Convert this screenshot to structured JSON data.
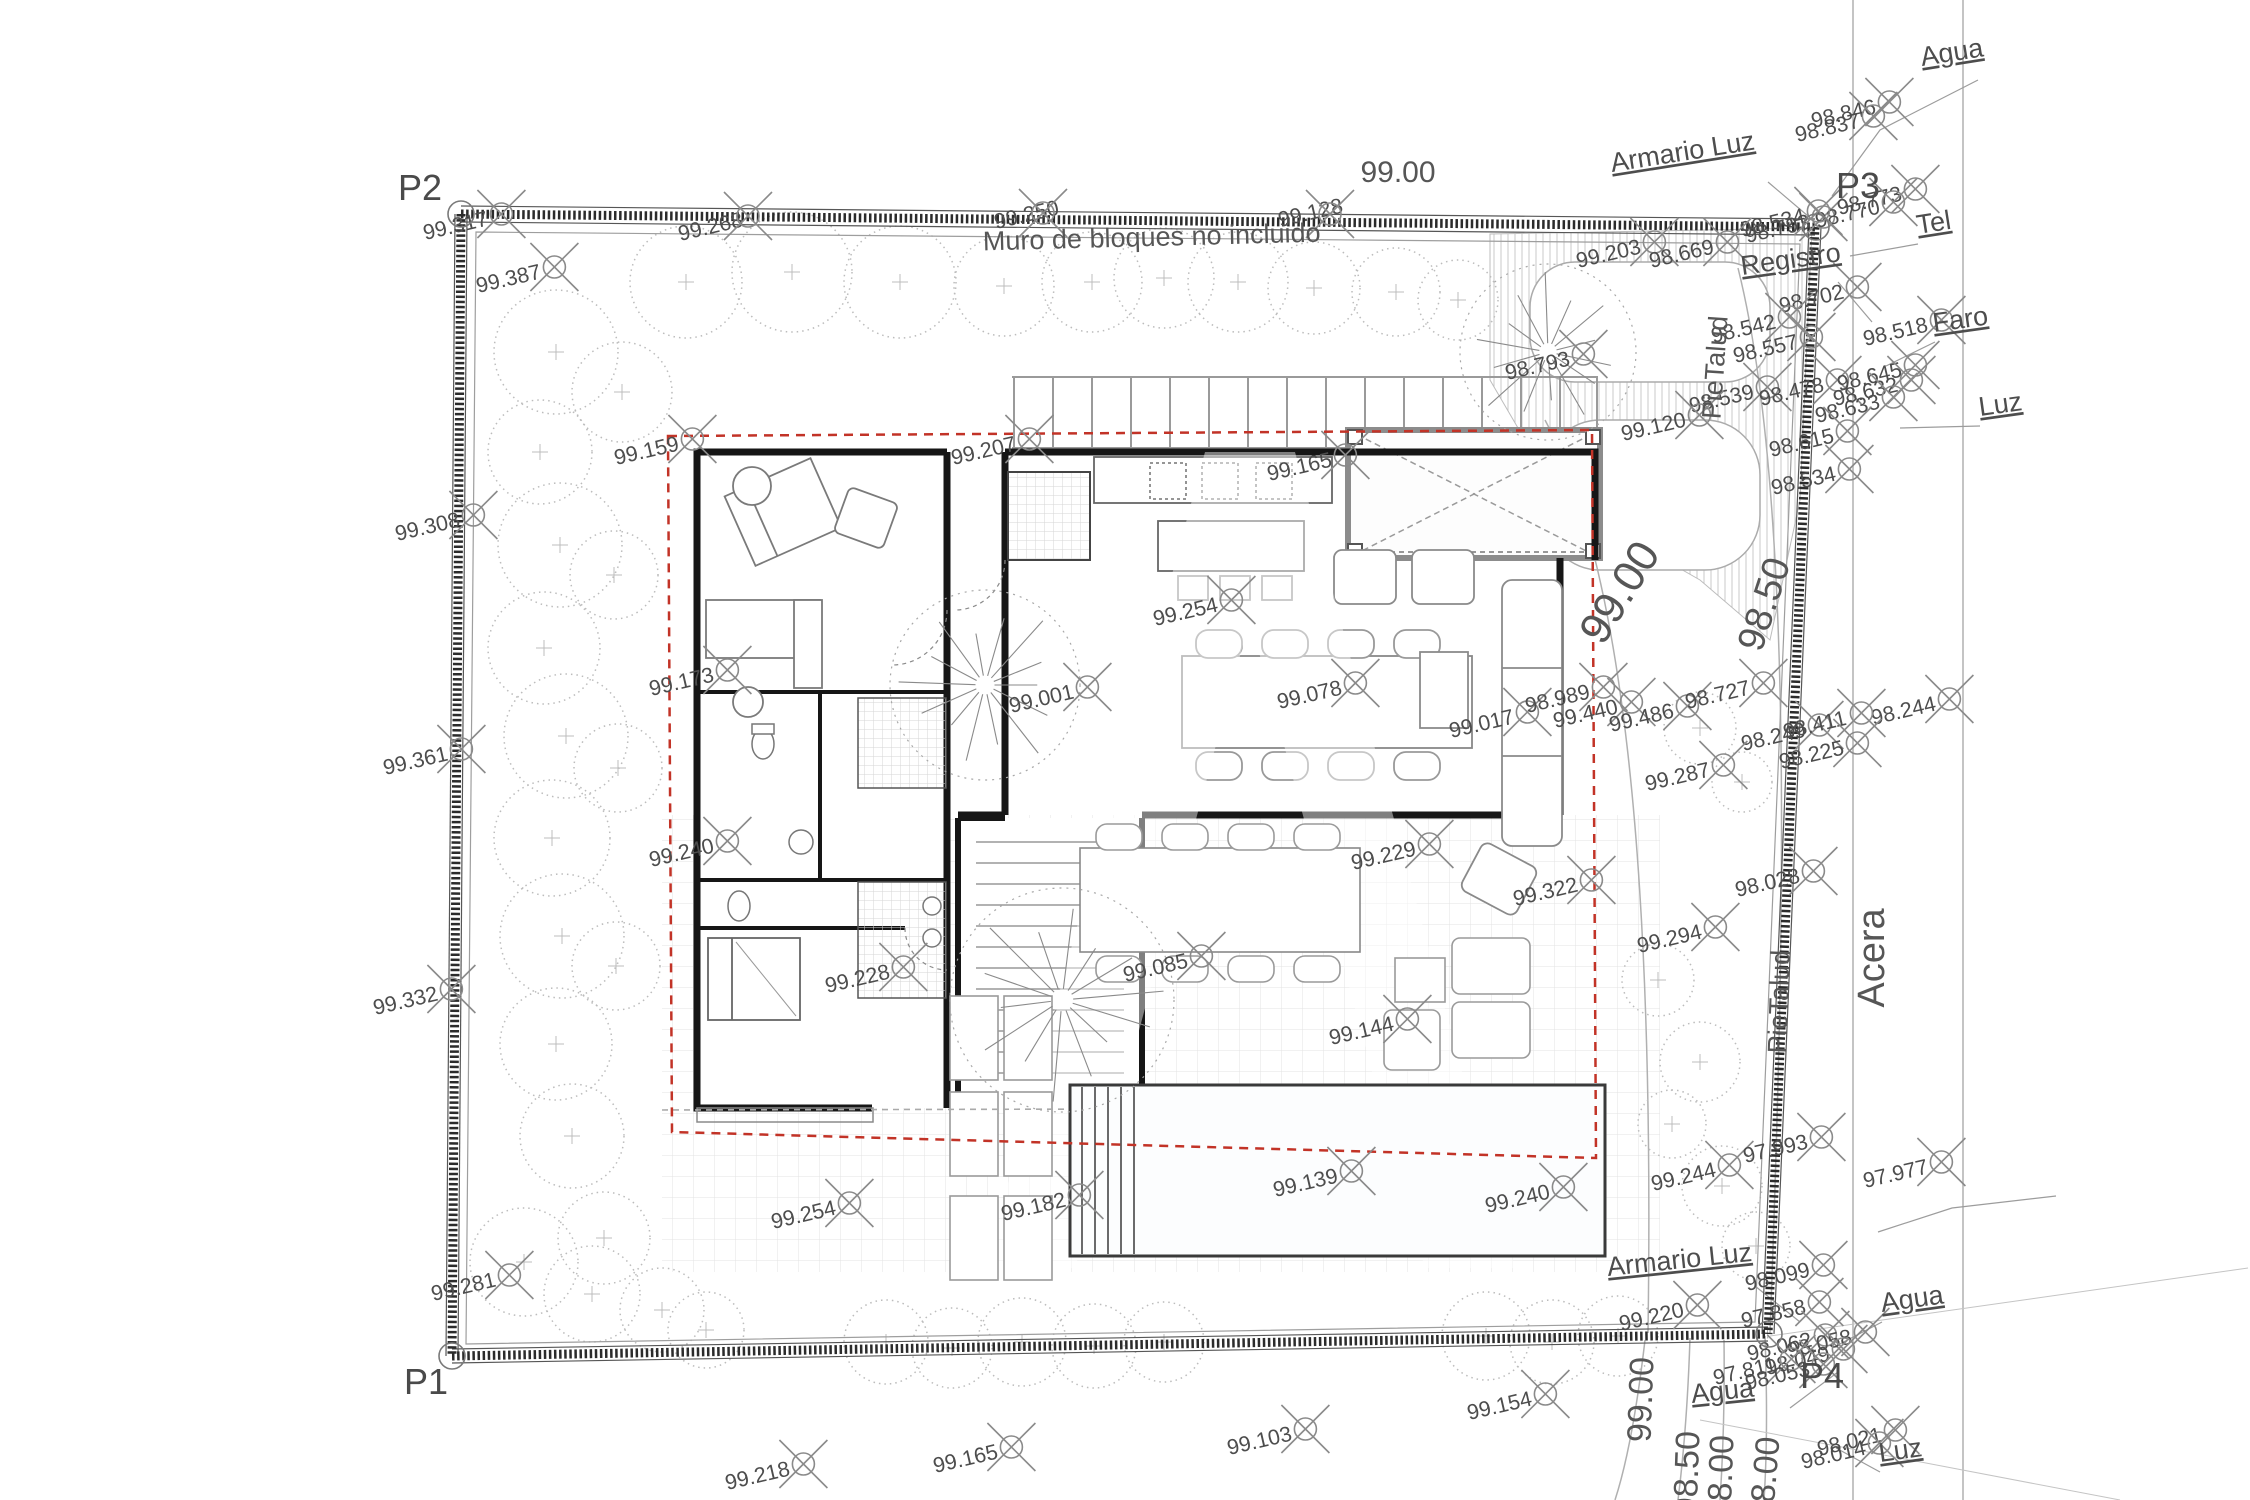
{
  "plan": {
    "wall_note": "Muro de bloques no incluido",
    "street_label": "Acera",
    "corner_points": [
      {
        "t": "P1",
        "x": 404,
        "y": 1394,
        "cx": 452,
        "cy": 1356
      },
      {
        "t": "P2",
        "x": 398,
        "y": 200,
        "cx": 461,
        "cy": 214
      },
      {
        "t": "P3",
        "x": 1836,
        "y": 198,
        "cx": 1816,
        "cy": 227
      },
      {
        "t": "P4",
        "x": 1800,
        "y": 1388,
        "cx": 1769,
        "cy": 1334
      }
    ],
    "big_labels": [
      [
        "99.00",
        1398,
        182,
        0,
        30
      ],
      [
        "Muro de bloques no incluido",
        1152,
        246,
        -1.5,
        27
      ],
      [
        "99.00",
        1632,
        600,
        -58,
        44
      ],
      [
        "98.50",
        1776,
        608,
        -72,
        38
      ],
      [
        "Acera",
        1884,
        958,
        -90,
        38
      ],
      [
        "PieTalud",
        1724,
        368,
        -86,
        27
      ],
      [
        "PieTalud",
        1788,
        1002,
        -88,
        27
      ],
      [
        "99.00",
        1652,
        1400,
        -88,
        34
      ],
      [
        "98.50",
        1698,
        1474,
        -88,
        34
      ],
      [
        "98.00",
        1732,
        1478,
        -88,
        34
      ],
      [
        "98.00",
        1776,
        1480,
        -85,
        34
      ]
    ],
    "utility_labels": [
      [
        "Armario Luz",
        1612,
        172,
        -9
      ],
      [
        "Agua",
        1922,
        66,
        -9
      ],
      [
        "Tel",
        1918,
        234,
        -9
      ],
      [
        "Registro",
        1742,
        275,
        -8
      ],
      [
        "Faro",
        1934,
        332,
        -8
      ],
      [
        "Luz",
        1980,
        416,
        -8
      ],
      [
        "Armario Luz",
        1608,
        1276,
        -6
      ],
      [
        "Agua",
        1882,
        1312,
        -8
      ],
      [
        "Agua",
        1692,
        1403,
        -6
      ],
      [
        "Luz",
        1880,
        1462,
        -8
      ]
    ],
    "survey_points": [
      [
        "99.317",
        425,
        240
      ],
      [
        "99.387",
        478,
        293
      ],
      [
        "99.268",
        680,
        241,
        748,
        216
      ],
      [
        "99.250",
        996,
        229,
        1043,
        213
      ],
      [
        "99.128",
        1280,
        227,
        1330,
        214
      ],
      [
        "98.846",
        1813,
        128
      ],
      [
        "98.837",
        1797,
        142
      ],
      [
        "98.793",
        1747,
        243
      ],
      [
        "98.773",
        1839,
        215
      ],
      [
        "98.770",
        1817,
        228
      ],
      [
        "98.534",
        1742,
        237
      ],
      [
        "99.203",
        1578,
        268
      ],
      [
        "98.669",
        1651,
        268
      ],
      [
        "98.702",
        1781,
        313
      ],
      [
        "98.518",
        1865,
        346
      ],
      [
        "98.542",
        1713,
        343
      ],
      [
        "98.557",
        1735,
        363
      ],
      [
        "98.539",
        1691,
        413
      ],
      [
        "99.120",
        1623,
        441
      ],
      [
        "98.478",
        1761,
        406
      ],
      [
        "98.645",
        1839,
        391
      ],
      [
        "98.632",
        1835,
        406
      ],
      [
        "98.633",
        1817,
        423
      ],
      [
        "98.615",
        1771,
        457
      ],
      [
        "98.534",
        1773,
        495
      ],
      [
        "98.793",
        1507,
        380
      ],
      [
        "99.159",
        616,
        465
      ],
      [
        "99.207",
        953,
        465
      ],
      [
        "99.165",
        1269,
        481
      ],
      [
        "99.308",
        397,
        541
      ],
      [
        "99.254",
        1155,
        626
      ],
      [
        "99.173",
        651,
        696
      ],
      [
        "99.001",
        1011,
        713
      ],
      [
        "99.078",
        1279,
        709
      ],
      [
        "99.017",
        1451,
        738
      ],
      [
        "98.989",
        1527,
        713
      ],
      [
        "99.440",
        1555,
        728
      ],
      [
        "99.486",
        1611,
        732
      ],
      [
        "98.727",
        1687,
        709
      ],
      [
        "98.244",
        1873,
        725
      ],
      [
        "98.249",
        1743,
        751
      ],
      [
        "98.411",
        1785,
        739
      ],
      [
        "98.225",
        1781,
        769
      ],
      [
        "99.361",
        385,
        775
      ],
      [
        "99.287",
        1647,
        791
      ],
      [
        "99.229",
        1353,
        870
      ],
      [
        "99.322",
        1515,
        906
      ],
      [
        "98.028",
        1737,
        897
      ],
      [
        "99.294",
        1639,
        953
      ],
      [
        "99.240",
        651,
        867
      ],
      [
        "99.228",
        827,
        993
      ],
      [
        "99.085",
        1125,
        982
      ],
      [
        "99.144",
        1331,
        1045
      ],
      [
        "99.332",
        375,
        1015
      ],
      [
        "99.244",
        1653,
        1191
      ],
      [
        "97.993",
        1745,
        1163
      ],
      [
        "97.977",
        1865,
        1188
      ],
      [
        "99.240",
        1487,
        1213
      ],
      [
        "99.139",
        1275,
        1197
      ],
      [
        "99.182",
        1003,
        1221
      ],
      [
        "99.254",
        773,
        1229
      ],
      [
        "99.281",
        433,
        1301
      ],
      [
        "99.220",
        1621,
        1331
      ],
      [
        "98.099",
        1747,
        1291
      ],
      [
        "97.858",
        1743,
        1328
      ],
      [
        "98.062",
        1749,
        1361
      ],
      [
        "98.058",
        1789,
        1358
      ],
      [
        "98.049",
        1767,
        1375
      ],
      [
        "97.811",
        1715,
        1385
      ],
      [
        "98.053",
        1747,
        1390
      ],
      [
        "98.021",
        1819,
        1456
      ],
      [
        "98.014",
        1803,
        1469
      ],
      [
        "99.154",
        1469,
        1420
      ],
      [
        "99.103",
        1229,
        1455
      ],
      [
        "99.165",
        935,
        1473
      ],
      [
        "99.218",
        727,
        1490
      ]
    ],
    "trees_dotted": [
      [
        556,
        352,
        62
      ],
      [
        622,
        392,
        50
      ],
      [
        540,
        452,
        52
      ],
      [
        560,
        545,
        62
      ],
      [
        614,
        575,
        44
      ],
      [
        544,
        648,
        56
      ],
      [
        566,
        736,
        62
      ],
      [
        618,
        768,
        44
      ],
      [
        552,
        838,
        58
      ],
      [
        562,
        936,
        62
      ],
      [
        616,
        966,
        44
      ],
      [
        556,
        1044,
        56
      ],
      [
        572,
        1136,
        52
      ],
      [
        604,
        1238,
        46
      ],
      [
        524,
        1262,
        54
      ],
      [
        592,
        1294,
        48
      ],
      [
        662,
        1310,
        42
      ],
      [
        706,
        1330,
        38
      ],
      [
        686,
        282,
        56
      ],
      [
        792,
        272,
        60
      ],
      [
        900,
        282,
        56
      ],
      [
        1004,
        286,
        50
      ],
      [
        1092,
        282,
        50
      ],
      [
        1164,
        278,
        50
      ],
      [
        1238,
        282,
        50
      ],
      [
        1314,
        288,
        46
      ],
      [
        1396,
        292,
        44
      ],
      [
        1458,
        300,
        40
      ],
      [
        886,
        1342,
        42
      ],
      [
        952,
        1348,
        40
      ],
      [
        1022,
        1342,
        44
      ],
      [
        1094,
        1346,
        42
      ],
      [
        1164,
        1342,
        40
      ],
      [
        1486,
        1336,
        44
      ],
      [
        1552,
        1342,
        42
      ],
      [
        1618,
        1336,
        40
      ],
      [
        1700,
        728,
        36
      ],
      [
        1742,
        782,
        30
      ],
      [
        1658,
        980,
        36
      ],
      [
        1700,
        1062,
        40
      ],
      [
        1672,
        1124,
        34
      ],
      [
        1722,
        1186,
        40
      ],
      [
        1756,
        1246,
        34
      ]
    ],
    "trees_branch": [
      [
        985,
        685,
        95
      ],
      [
        1062,
        1000,
        112
      ],
      [
        1548,
        352,
        88
      ]
    ]
  }
}
